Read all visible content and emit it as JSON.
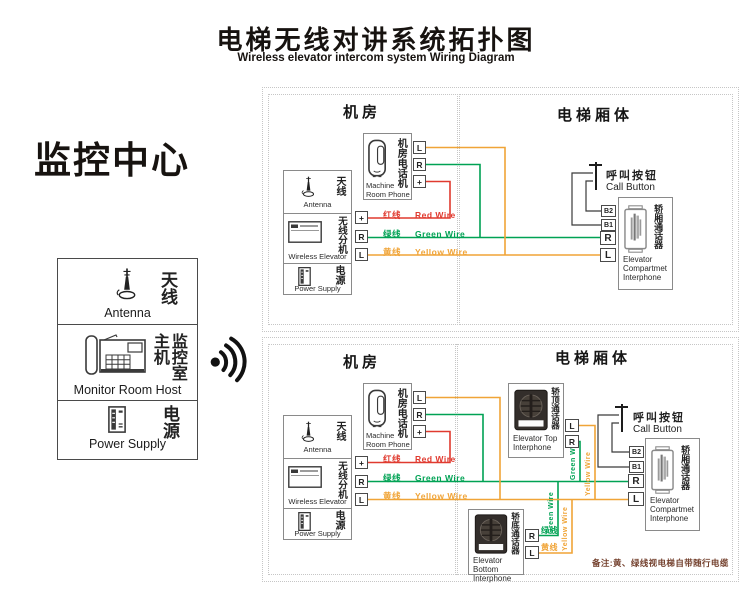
{
  "header": {
    "title_cn": "电梯无线对讲系统拓扑图",
    "title_en": "Wireless elevator intercom system Wiring Diagram"
  },
  "monitor_center": {
    "title": "监控中心",
    "antenna_cn": "天线",
    "antenna_en": "Antenna",
    "host_cn": "监控室主机",
    "host_en": "Monitor Room Host",
    "power_cn": "电源",
    "power_en": "Power Supply"
  },
  "labels": {
    "machine_room": "机房",
    "elevator_body": "电梯厢体"
  },
  "machine_room_phone": {
    "cn": "机房电话机",
    "en": "Machine Room Phone",
    "terminals": [
      "L",
      "R",
      "+"
    ]
  },
  "wireless_unit": {
    "antenna_cn": "天线",
    "antenna_en": "Antenna",
    "cn": "无线分机",
    "en": "Wireless Elevator",
    "power_cn": "电源",
    "power_en": "Power Supply",
    "terminals": [
      "+",
      "R",
      "L"
    ]
  },
  "wires": {
    "red_cn": "红线",
    "red_en": "Red Wire",
    "red_color": "#e03a2f",
    "green_cn": "绿线",
    "green_en": "Green Wire",
    "green_color": "#00a254",
    "yellow_cn": "黄线",
    "yellow_en": "Yellow Wire",
    "yellow_color": "#f0a437",
    "black_color": "#3a3a3a"
  },
  "call_button": {
    "cn": "呼叫按钮",
    "en": "Call Button"
  },
  "compartment_interphone": {
    "cn": "轿厢通话器",
    "en": "Elevator Compartmet Interphone",
    "terminals": [
      "B2",
      "B1",
      "R",
      "L"
    ]
  },
  "top_interphone": {
    "cn": "轿顶通话器",
    "en": "Elevator Top Interphone",
    "terminals": [
      "L",
      "R"
    ]
  },
  "bottom_interphone": {
    "cn": "轿底通话器",
    "en": "Elevator Bottom Interphone",
    "terminals": [
      "R",
      "L"
    ],
    "r_wire_cn": "绿线",
    "l_wire_cn": "黄线"
  },
  "note": "备注:黄、绿线视电梯自带随行电缆"
}
